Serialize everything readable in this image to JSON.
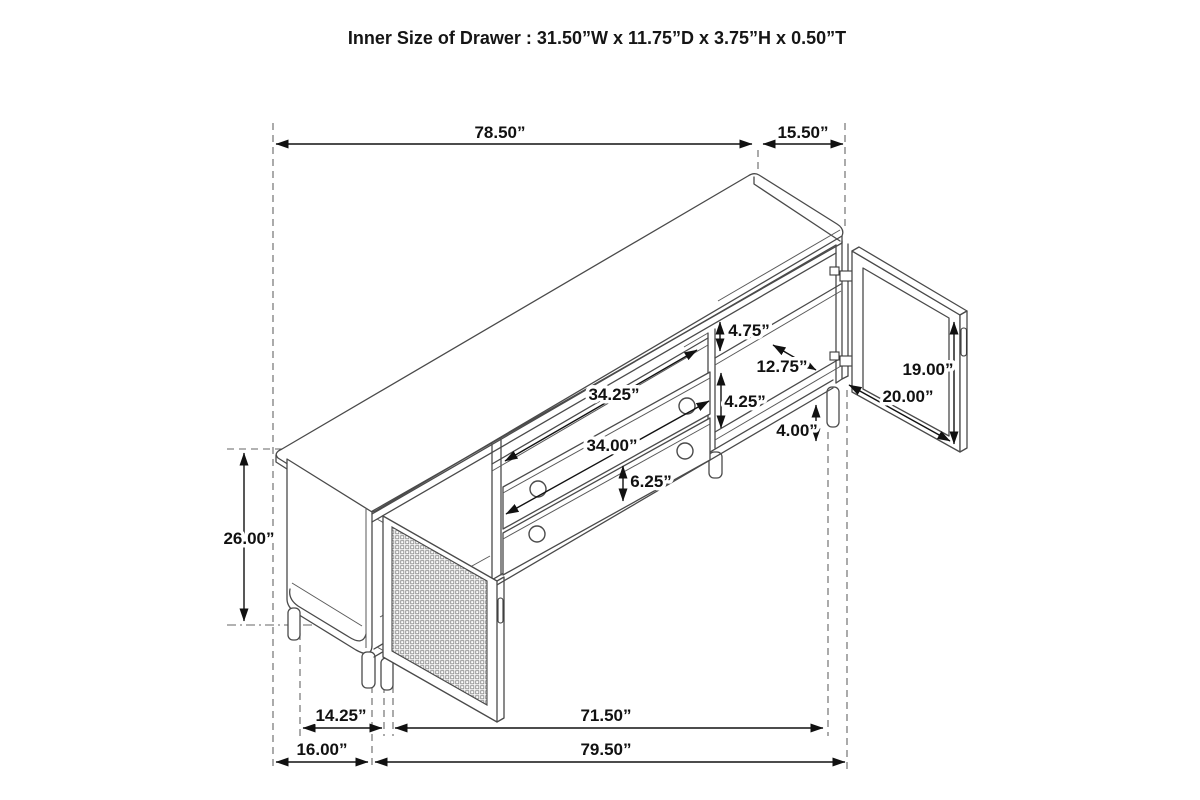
{
  "title": "Inner Size of Drawer : 31.50”W x 11.75”D x 3.75”H x 0.50”T",
  "dimensions": {
    "top_length": "78.50”",
    "top_depth": "15.50”",
    "overall_height": "26.00”",
    "upper_shelf_gap": "4.75”",
    "compartment_inner_depth": "12.75”",
    "shelf_spacing": "4.25”",
    "leg_height": "4.00”",
    "drawer_opening_width": "34.25”",
    "drawer_front_width": "34.00”",
    "drawer_front_height": "6.25”",
    "door_height": "19.00”",
    "door_width": "20.00”",
    "base_side_inner_depth": "14.25”",
    "base_front_inner_width": "71.50”",
    "base_side_depth": "16.00”",
    "base_front_width": "79.50”"
  }
}
